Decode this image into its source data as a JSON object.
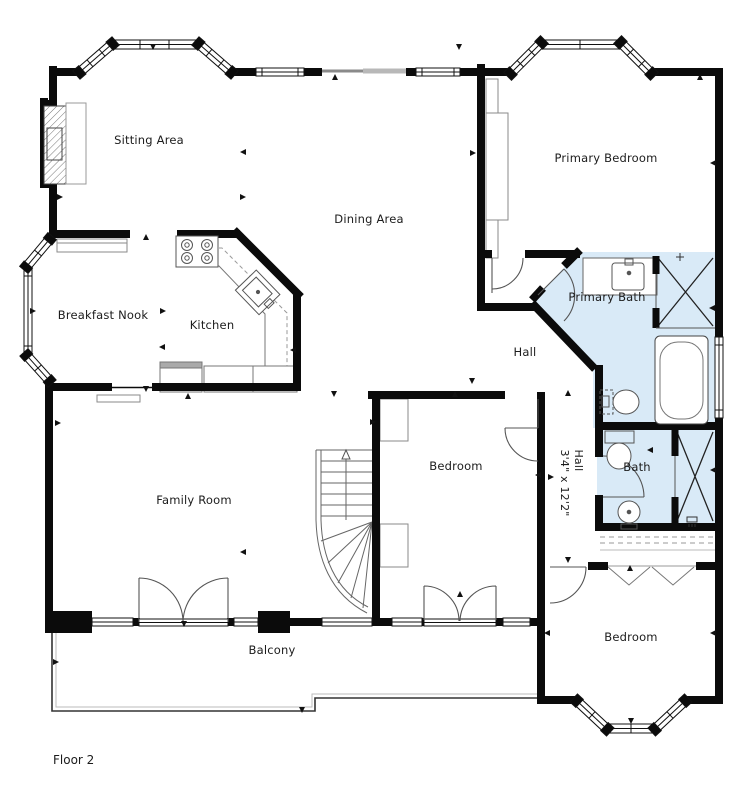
{
  "floor_plan": {
    "floor_label": "Floor 2",
    "rooms": {
      "sitting_area": "Sitting Area",
      "dining_area": "Dining Area",
      "primary_bedroom": "Primary Bedroom",
      "breakfast_nook": "Breakfast Nook",
      "kitchen": "Kitchen",
      "primary_bath": "Primary Bath",
      "hall": "Hall",
      "bedroom_middle": "Bedroom",
      "bath": "Bath",
      "family_room": "Family Room",
      "balcony": "Balcony",
      "bedroom_bottom": "Bedroom"
    },
    "hall_dimension": {
      "name": "Hall",
      "size": "3'4\" x 12'2\""
    },
    "colors": {
      "wall": "#0b0b0b",
      "bath_fill": "#d9eaf7",
      "label": "#1c1c1c"
    }
  }
}
